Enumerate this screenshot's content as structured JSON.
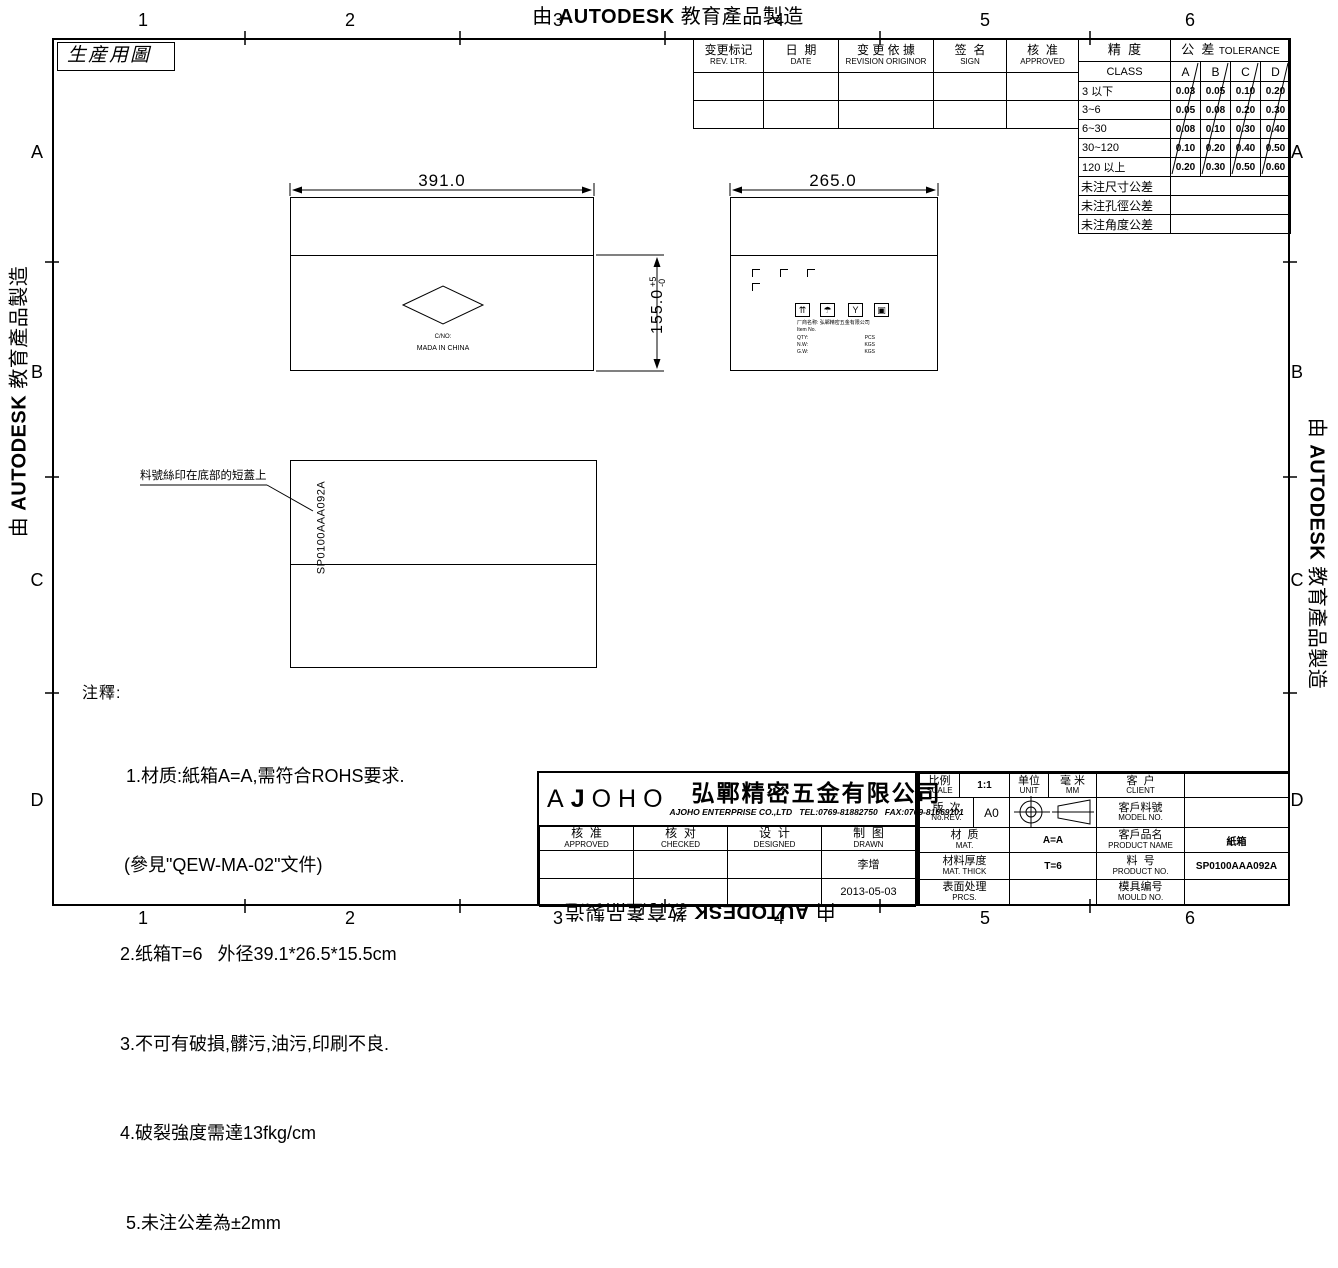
{
  "watermark": {
    "prefix": "由 ",
    "brand": "AUTODESK",
    "suffix": " 教育產品製造"
  },
  "sheet": {
    "doc_type": "生産用圖"
  },
  "grid": {
    "cols": [
      "1",
      "2",
      "3",
      "4",
      "5",
      "6"
    ],
    "rows": [
      "A",
      "B",
      "C",
      "D"
    ]
  },
  "revision_table": {
    "headers": [
      {
        "zh": "变更标记",
        "en": "REV. LTR."
      },
      {
        "zh": "日  期",
        "en": "DATE"
      },
      {
        "zh": "变 更 依 據",
        "en": "REVISION ORIGINOR"
      },
      {
        "zh": "签  名",
        "en": "SIGN"
      },
      {
        "zh": "核  准",
        "en": "APPROVED"
      }
    ]
  },
  "tolerance_table": {
    "class_zh": "精  度",
    "class_en": "CLASS",
    "tol_zh": "公  差",
    "tol_en": "TOLERANCE",
    "cols": [
      "A",
      "B",
      "C",
      "D"
    ],
    "rows": [
      {
        "range": "3 以下",
        "vals": [
          "0.03",
          "0.05",
          "0.10",
          "0.20"
        ]
      },
      {
        "range": "3~6",
        "vals": [
          "0.05",
          "0.08",
          "0.20",
          "0.30"
        ]
      },
      {
        "range": "6~30",
        "vals": [
          "0.08",
          "0.10",
          "0.30",
          "0.40"
        ]
      },
      {
        "range": "30~120",
        "vals": [
          "0.10",
          "0.20",
          "0.40",
          "0.50"
        ]
      },
      {
        "range": "120 以上",
        "vals": [
          "0.20",
          "0.30",
          "0.50",
          "0.60"
        ]
      }
    ],
    "notes": [
      "未注尺寸公差",
      "未注孔徑公差",
      "未注角度公差"
    ]
  },
  "views": {
    "top": {
      "width_dim": "391.0",
      "height_dim": "155.0",
      "height_tol_plus": "+5",
      "height_tol_minus": "-0",
      "cno": "C/NO:",
      "origin": "MADA IN CHINA"
    },
    "side": {
      "width_dim": "265.0",
      "icon_glyphs": [
        "⇈",
        "☂",
        "Y",
        "▣"
      ],
      "mfr_line": "厂商名称: 弘鄲精密五金有限公司",
      "item_line": "Item No.",
      "qty_label": "QTY:",
      "qty_value": "PCS",
      "nw_label": "N.W:",
      "nw_value": "KGS",
      "gw_label": "G.W:",
      "gw_value": "KGS"
    },
    "bottom": {
      "part_no": "SP0100AAA092A",
      "leader_note": "料號絲印在底部的短蓋上"
    }
  },
  "notes": {
    "title": "注釋:",
    "items": [
      "1.材质:紙箱A=A,需符合ROHS要求.",
      "(參見\"QEW-MA-02\"文件)",
      "2.纸箱T=6   外径39.1*26.5*15.5cm",
      "3.不可有破損,髒污,油污,印刷不良.",
      "4.破裂強度需達13fkg/cm",
      "5.未注公差為±2mm"
    ]
  },
  "title_block": {
    "logo_a": "A",
    "logo_j": "J",
    "logo_rest": "OHO",
    "company_zh": "弘鄲精密五金有限公司",
    "company_en": "AJOHO ENTERPRISE CO.,LTD   TEL:0769-81882750   FAX:0769-81669101",
    "approved_zh": "核  准",
    "approved_en": "APPROVED",
    "checked_zh": "核  对",
    "checked_en": "CHECKED",
    "designed_zh": "设  计",
    "designed_en": "DESIGNED",
    "drawn_zh": "制  图",
    "drawn_en": "DRAWN",
    "drawn_name": "李增",
    "drawn_date": "2013-05-03",
    "scale_zh": "比例",
    "scale_en": "SCALE",
    "scale_value": "1:1",
    "unit_zh": "单位",
    "unit_en": "UNIT",
    "unit_value_zh": "毫 米",
    "unit_value_en": "MM",
    "client_zh": "客  户",
    "client_en": "CLIENT",
    "client_value": "",
    "rev_zh": "版  次",
    "rev_en": "No.REV.",
    "rev_value": "A0",
    "model_zh": "客戶料號",
    "model_en": "MODEL NO.",
    "model_value": "",
    "mat_zh": "材  质",
    "mat_en": "MAT.",
    "mat_value": "A=A",
    "pname_zh": "客戶品名",
    "pname_en": "PRODUCT NAME",
    "pname_value": "紙箱",
    "thick_zh": "材料厚度",
    "thick_en": "MAT. THICK",
    "thick_value": "T=6",
    "pno_zh": "料  号",
    "pno_en": "PRODUCT NO.",
    "pno_value": "SP0100AAA092A",
    "prcs_zh": "表面处理",
    "prcs_en": "PRCS.",
    "prcs_value": "",
    "mould_zh": "模具编号",
    "mould_en": "MOULD NO.",
    "mould_value": ""
  }
}
